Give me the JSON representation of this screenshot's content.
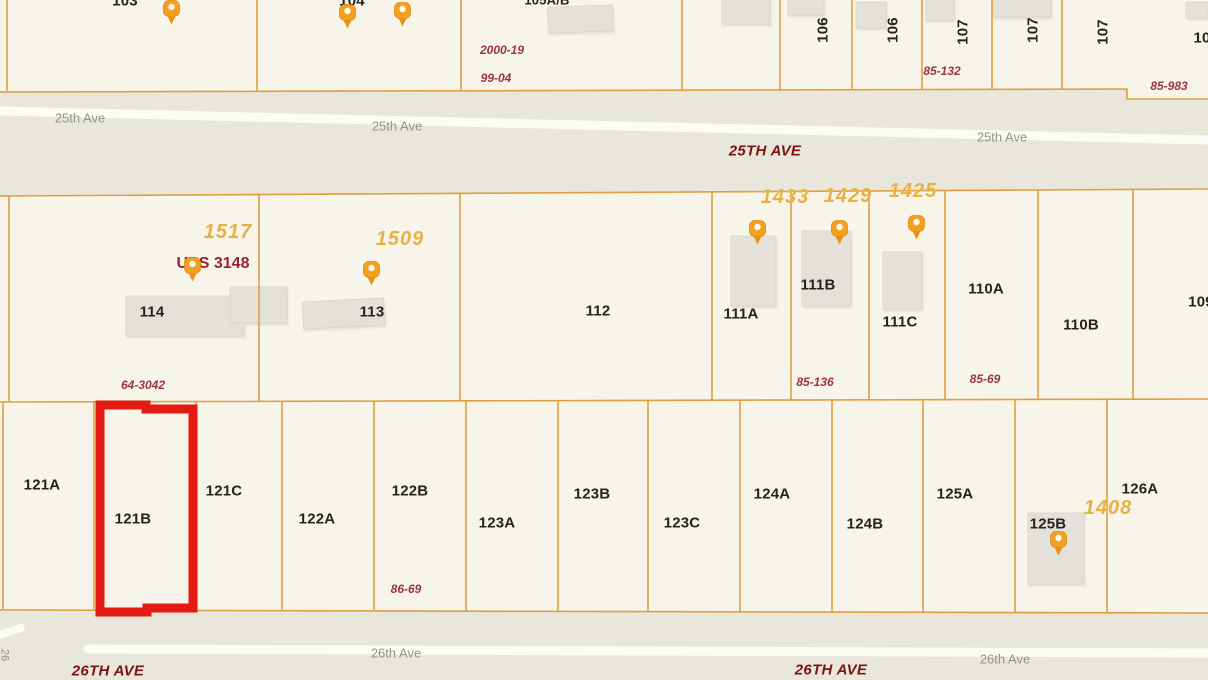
{
  "map_title": "Parcel map between 25th Ave and 26th Ave",
  "colors": {
    "parcel_fill": "#f7f4e9",
    "street_band": "#e9e7db",
    "boundary_line": "#df9f40",
    "road_line": "#fcfcf7",
    "highlight_red": "#e51b13",
    "pin_orange": "#f3a01e",
    "parcel_label": "#262320",
    "address_orange": "#e7b145",
    "plat_ref_red": "#9c3440",
    "street_label_gray": "#93928c",
    "street_label_dark_red": "#7c1410",
    "building_gray": "#e3e1da"
  },
  "highlight": {
    "parcel": "121B"
  },
  "labels": {
    "parcels": [
      {
        "t": "103",
        "x": 125,
        "y": 1
      },
      {
        "t": "104",
        "x": 352,
        "y": 1
      },
      {
        "t": "105A/B",
        "x": 547,
        "y": 0,
        "fs": 13
      },
      {
        "t": "106",
        "x": 823,
        "y": 30,
        "rot": -90
      },
      {
        "t": "106",
        "x": 893,
        "y": 30,
        "rot": -90
      },
      {
        "t": "107",
        "x": 963,
        "y": 32,
        "rot": -90
      },
      {
        "t": "107",
        "x": 1033,
        "y": 30,
        "rot": -90
      },
      {
        "t": "107",
        "x": 1103,
        "y": 32,
        "rot": -90
      },
      {
        "t": "10",
        "x": 1202,
        "y": 38
      },
      {
        "t": "114",
        "x": 152,
        "y": 312
      },
      {
        "t": "113",
        "x": 372,
        "y": 312
      },
      {
        "t": "112",
        "x": 598,
        "y": 311
      },
      {
        "t": "111A",
        "x": 741,
        "y": 314
      },
      {
        "t": "111B",
        "x": 818,
        "y": 285
      },
      {
        "t": "111C",
        "x": 900,
        "y": 322
      },
      {
        "t": "110A",
        "x": 986,
        "y": 289
      },
      {
        "t": "110B",
        "x": 1081,
        "y": 325
      },
      {
        "t": "109",
        "x": 1201,
        "y": 302
      },
      {
        "t": "121A",
        "x": 42,
        "y": 485
      },
      {
        "t": "121B",
        "x": 133,
        "y": 519
      },
      {
        "t": "121C",
        "x": 224,
        "y": 491
      },
      {
        "t": "122A",
        "x": 317,
        "y": 519
      },
      {
        "t": "122B",
        "x": 410,
        "y": 491
      },
      {
        "t": "123A",
        "x": 497,
        "y": 523
      },
      {
        "t": "123B",
        "x": 592,
        "y": 494
      },
      {
        "t": "123C",
        "x": 682,
        "y": 523
      },
      {
        "t": "124A",
        "x": 772,
        "y": 494
      },
      {
        "t": "124B",
        "x": 865,
        "y": 524
      },
      {
        "t": "125A",
        "x": 955,
        "y": 494
      },
      {
        "t": "125B",
        "x": 1048,
        "y": 524
      },
      {
        "t": "126A",
        "x": 1140,
        "y": 489
      }
    ],
    "addresses": [
      {
        "t": "1517",
        "x": 228,
        "y": 232
      },
      {
        "t": "1509",
        "x": 400,
        "y": 239
      },
      {
        "t": "1433",
        "x": 785,
        "y": 197
      },
      {
        "t": "1429",
        "x": 848,
        "y": 196
      },
      {
        "t": "1425",
        "x": 913,
        "y": 191
      },
      {
        "t": "1408",
        "x": 1108,
        "y": 508
      }
    ],
    "refs": [
      {
        "t": "2000-19",
        "x": 502,
        "y": 50
      },
      {
        "t": "99-04",
        "x": 496,
        "y": 78
      },
      {
        "t": "85-132",
        "x": 942,
        "y": 71
      },
      {
        "t": "85-983",
        "x": 1169,
        "y": 86
      },
      {
        "t": "64-3042",
        "x": 143,
        "y": 385
      },
      {
        "t": "85-136",
        "x": 815,
        "y": 382
      },
      {
        "t": "85-69",
        "x": 985,
        "y": 379
      },
      {
        "t": "86-69",
        "x": 406,
        "y": 589
      }
    ],
    "streets_small": [
      {
        "t": "25th Ave",
        "x": 80,
        "y": 118
      },
      {
        "t": "25th Ave",
        "x": 397,
        "y": 126
      },
      {
        "t": "25th Ave",
        "x": 1002,
        "y": 137
      },
      {
        "t": "26th Ave",
        "x": 396,
        "y": 653
      },
      {
        "t": "26th Ave",
        "x": 1005,
        "y": 659
      }
    ],
    "streets_big": [
      {
        "t": "25TH AVE",
        "x": 765,
        "y": 151
      },
      {
        "t": "26TH AVE",
        "x": 108,
        "y": 671
      },
      {
        "t": "26TH AVE",
        "x": 831,
        "y": 670
      }
    ],
    "pois": [
      {
        "t": "UPS 3148",
        "x": 213,
        "y": 264
      }
    ],
    "edge": [
      {
        "t": "26",
        "x": 4,
        "y": 655,
        "rot": 90
      }
    ]
  },
  "pins": [
    {
      "x": 162,
      "y": 0
    },
    {
      "x": 338,
      "y": 4
    },
    {
      "x": 393,
      "y": 2
    },
    {
      "x": 183,
      "y": 257
    },
    {
      "x": 362,
      "y": 261
    },
    {
      "x": 748,
      "y": 220
    },
    {
      "x": 830,
      "y": 220
    },
    {
      "x": 907,
      "y": 215
    },
    {
      "x": 1049,
      "y": 531
    }
  ]
}
